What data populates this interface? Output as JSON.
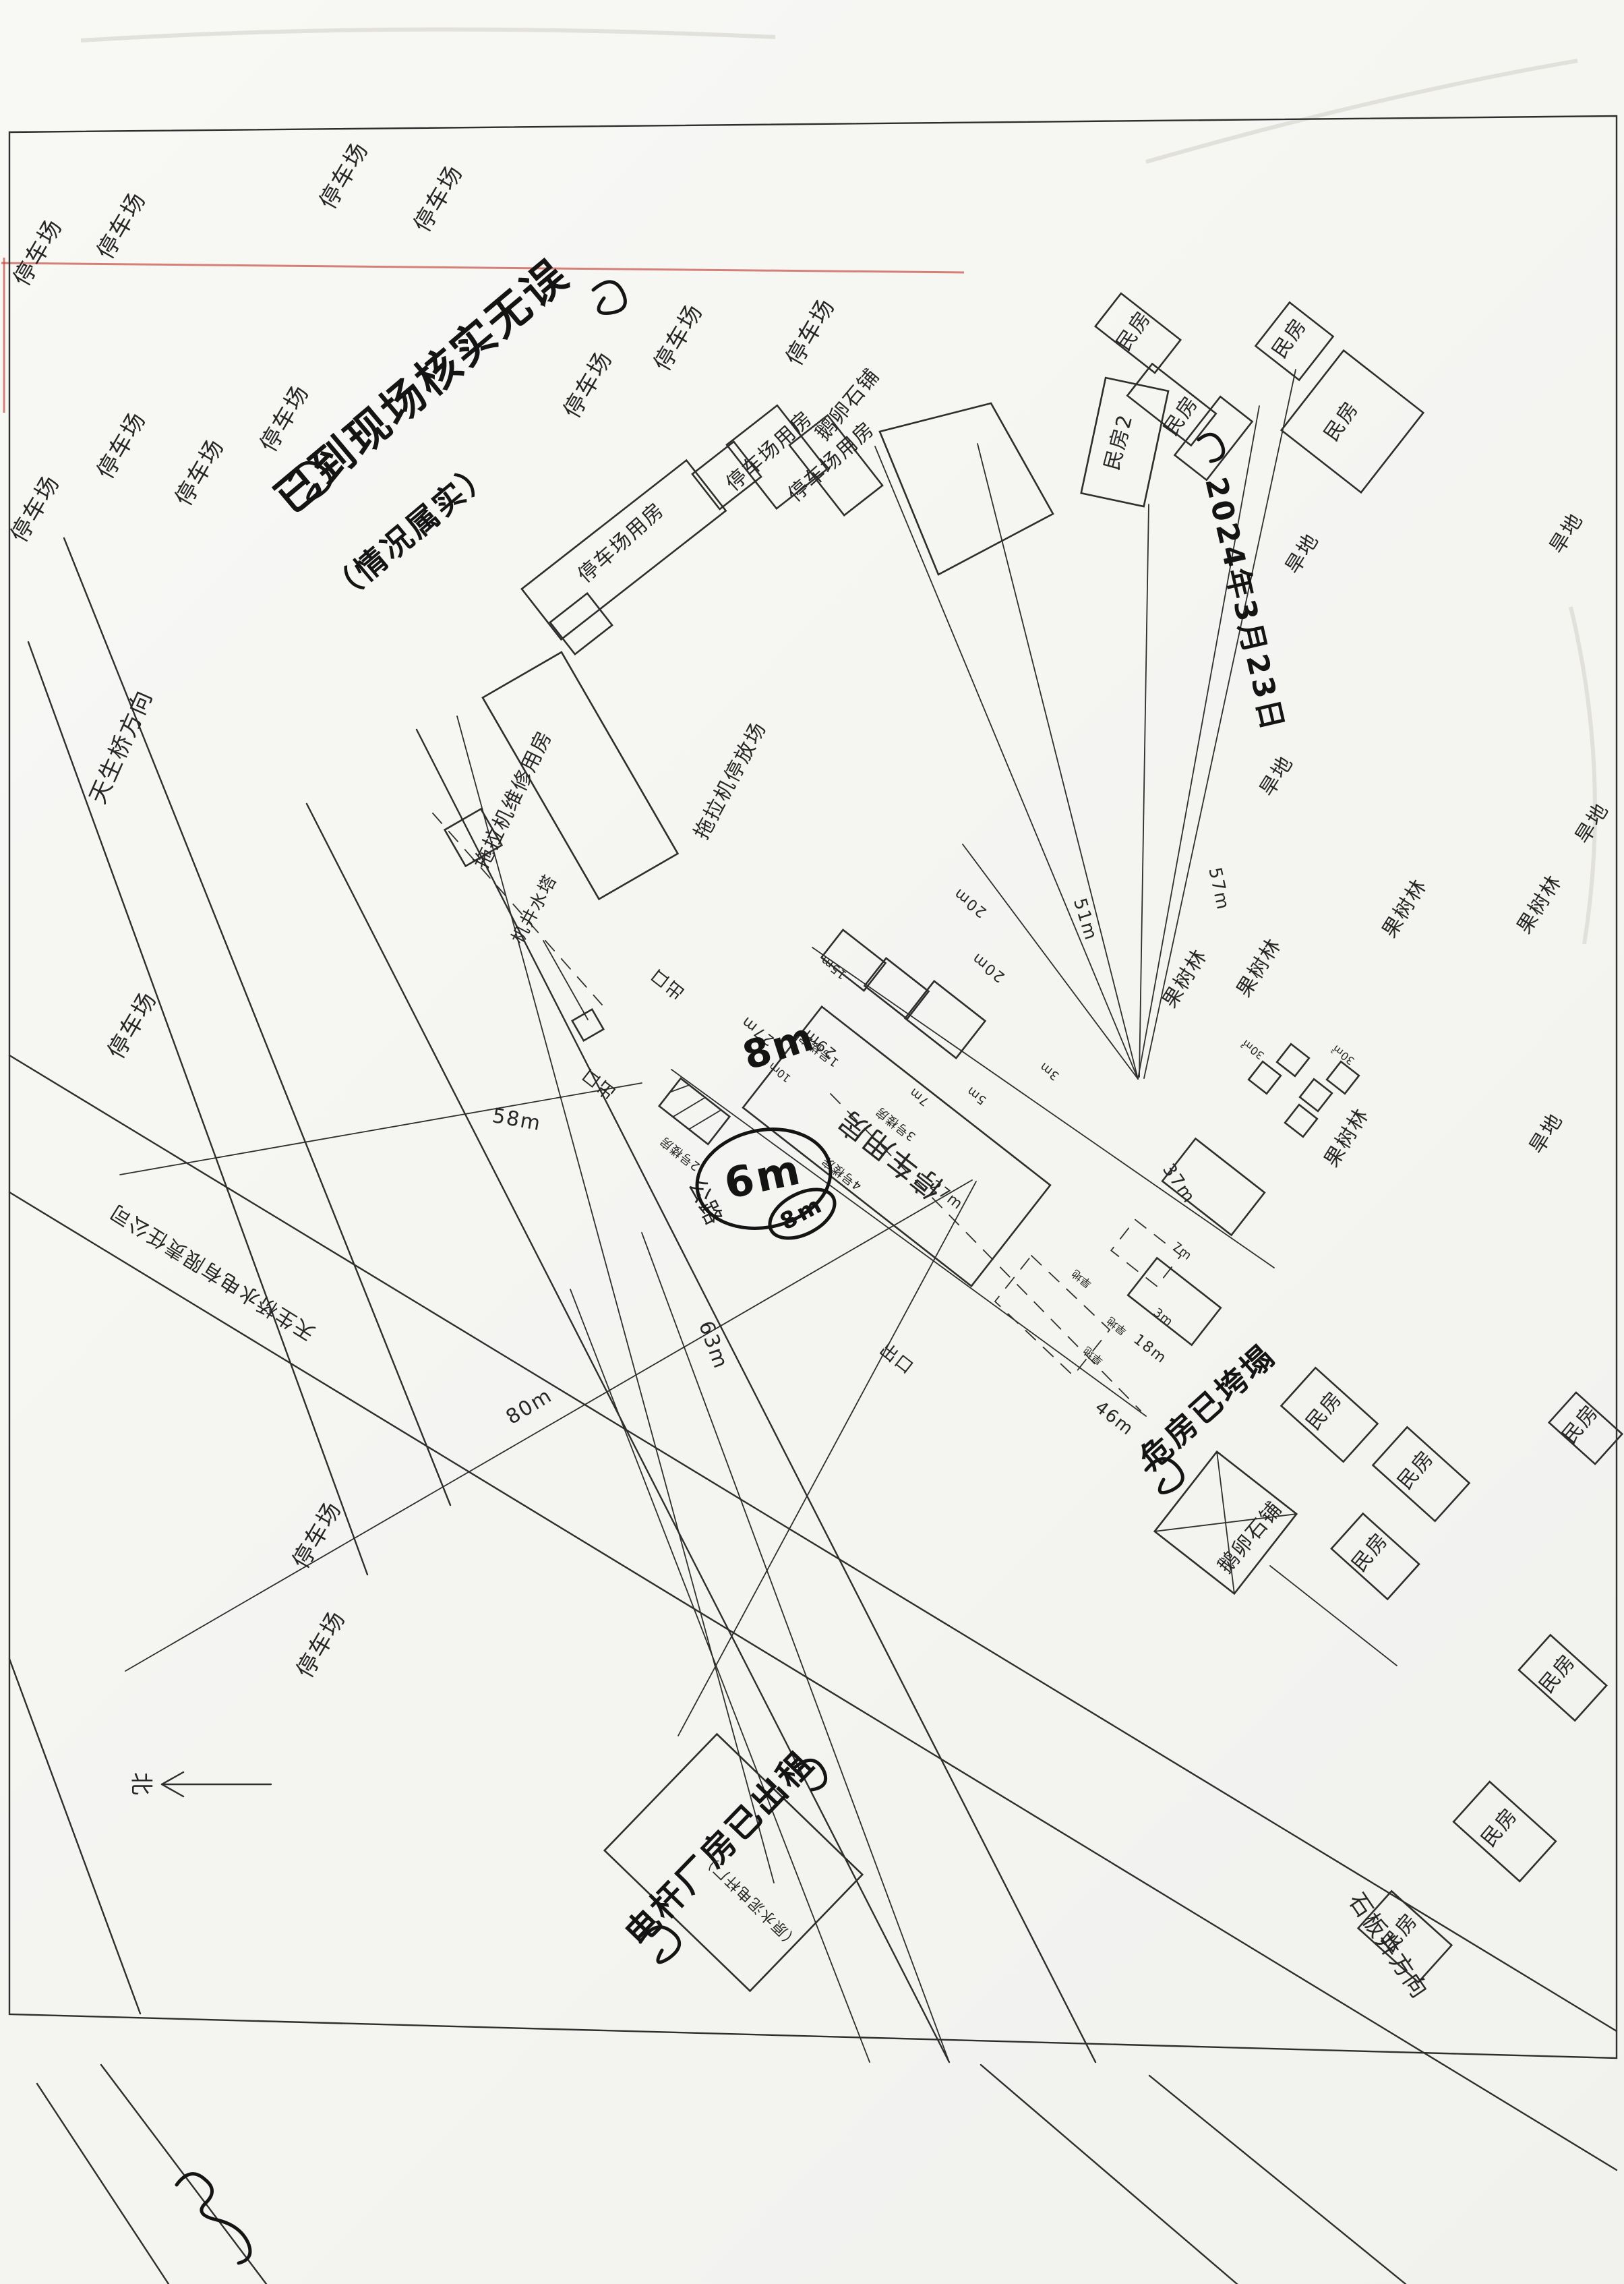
{
  "colors": {
    "paper": "#f6f6f3",
    "ink": "#2e2e2e",
    "scanner_artifact_red": "#c24136"
  },
  "labels": {
    "parking": "停车场",
    "parking_house": "停车场用房",
    "tractor_repair_house": "拖拉机维修用房",
    "tractor_yard": "拖拉机停放场",
    "well_tower": "机井水塔",
    "central_house": "停车用房",
    "bldg_no1": "1号楼房",
    "bldg_no2": "2号楼房",
    "bldg_no3": "3号楼房",
    "bldg_no4": "4号楼房",
    "residence": "民房",
    "residence2": "民房2",
    "orchard": "果树林",
    "dryland": "旱地",
    "cobble": "鹅卵石铺",
    "highway": "公路",
    "exit": "出口",
    "dir_tianshengqiao": "天生桥方向",
    "dir_shibanjing": "石板井方向",
    "company": "天生桥水电有限责任公司",
    "north": "北"
  },
  "distances": {
    "d58": "58m",
    "d80": "80m",
    "d63": "63m",
    "d57": "57m",
    "d51": "51m",
    "d46": "46m",
    "d37": "37m",
    "d29": "29m",
    "d27": "27m",
    "d20": "20m",
    "d18": "18m",
    "d15": "15m",
    "d10": "10m",
    "d7": "7m",
    "d5": "5m",
    "d3": "3m"
  },
  "areas": {
    "a30": "30㎡"
  },
  "handwriting": {
    "note_main_1": "已到现场核实无误",
    "note_main_2": "（情况属实）",
    "date": "2024年3月23日",
    "note_ruin": "危房已垮塌",
    "note_plant": "电杆厂房已出租",
    "m6": "6m",
    "m8": "8m"
  },
  "printed_small": {
    "plant_paren": "（原水泥电杆厂）"
  }
}
